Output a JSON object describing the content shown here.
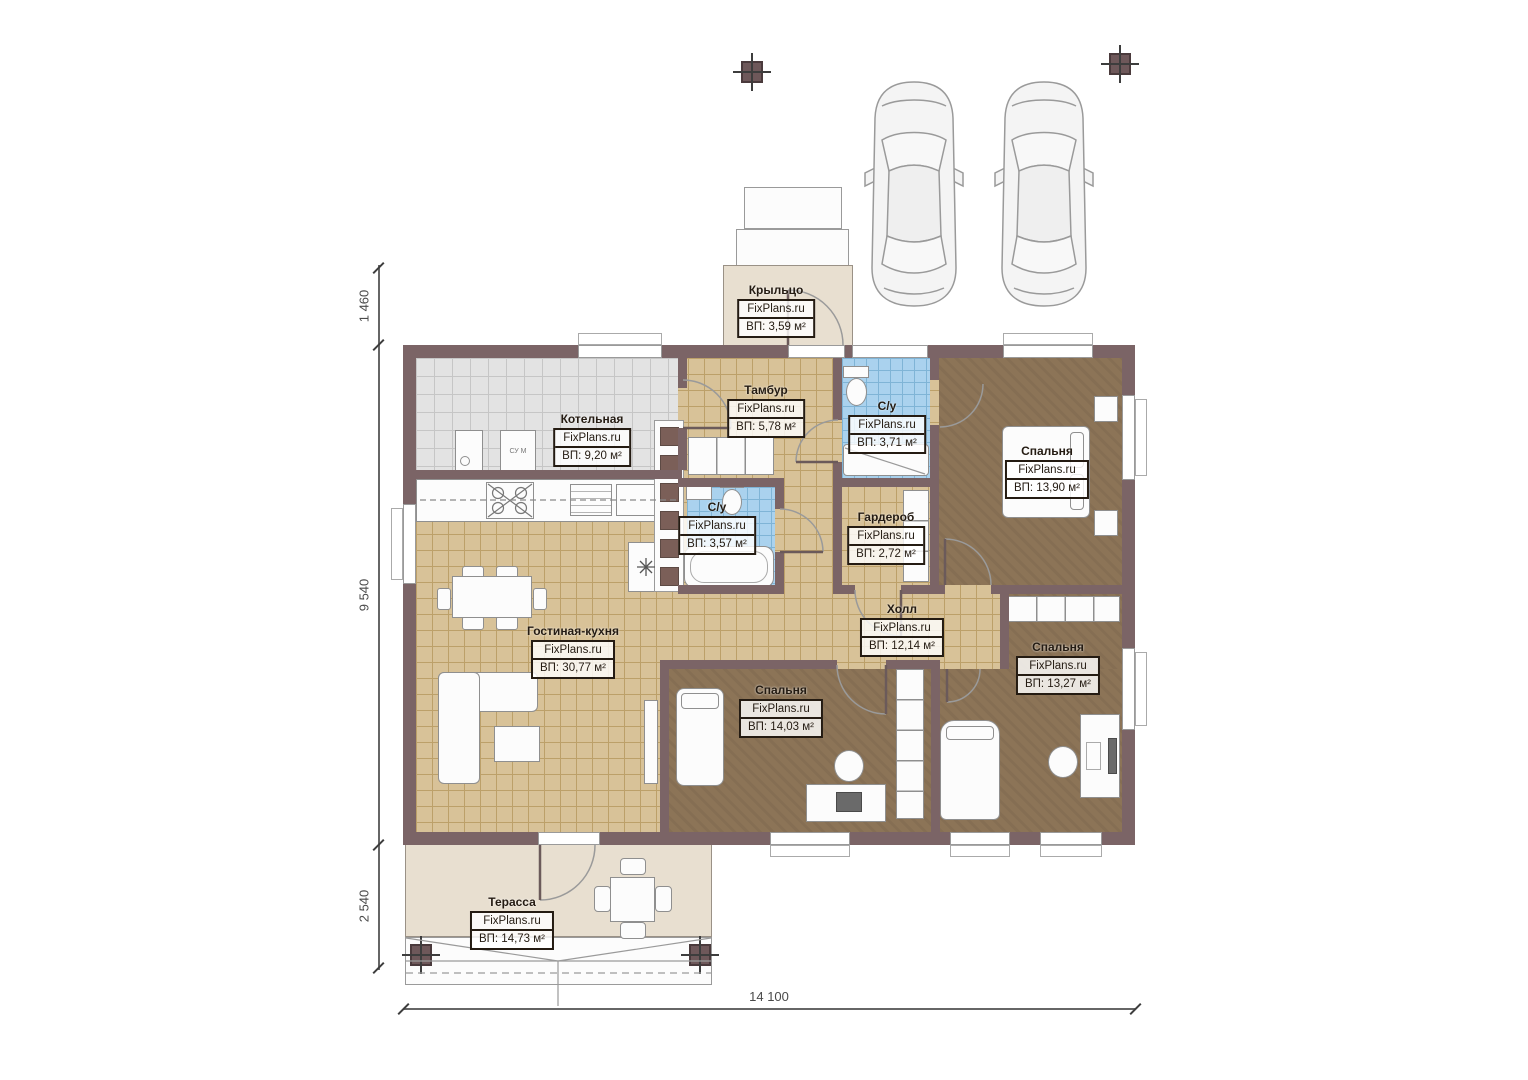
{
  "brand": "FixPlans.ru",
  "rooms": {
    "porch": {
      "name": "Крыльцо",
      "area": "ВП: 3,59 м²"
    },
    "boiler": {
      "name": "Котельная",
      "area": "ВП: 9,20 м²"
    },
    "tambur": {
      "name": "Тамбур",
      "area": "ВП: 5,78 м²"
    },
    "wc_top": {
      "name": "С/у",
      "area": "ВП: 3,71 м²"
    },
    "bedroom_top": {
      "name": "Спальня",
      "area": "ВП: 13,90 м²"
    },
    "wc_mid": {
      "name": "С/у",
      "area": "ВП: 3,57 м²"
    },
    "wardrobe": {
      "name": "Гардероб",
      "area": "ВП: 2,72 м²"
    },
    "hall": {
      "name": "Холл",
      "area": "ВП: 12,14 м²"
    },
    "living": {
      "name": "Гостиная-кухня",
      "area": "ВП: 30,77 м²"
    },
    "bedroom_mid": {
      "name": "Спальня",
      "area": "ВП: 14,03 м²"
    },
    "bedroom_right": {
      "name": "Спальня",
      "area": "ВП: 13,27 м²"
    },
    "terrace": {
      "name": "Терасса",
      "area": "ВП: 14,73 м²"
    }
  },
  "dimensions": {
    "left_top": "1 460",
    "left_middle": "9 540",
    "left_bottom": "2 540",
    "bottom_width": "14 100"
  },
  "labels": {
    "washer": "СУ М"
  },
  "colors": {
    "wall": "#7b6466",
    "floor_tan": "#d8c298",
    "floor_gray": "#e3e3e3",
    "floor_blue": "#aad2ee",
    "floor_brown": "#8c7457",
    "outdoor": "#e8dfd0"
  }
}
